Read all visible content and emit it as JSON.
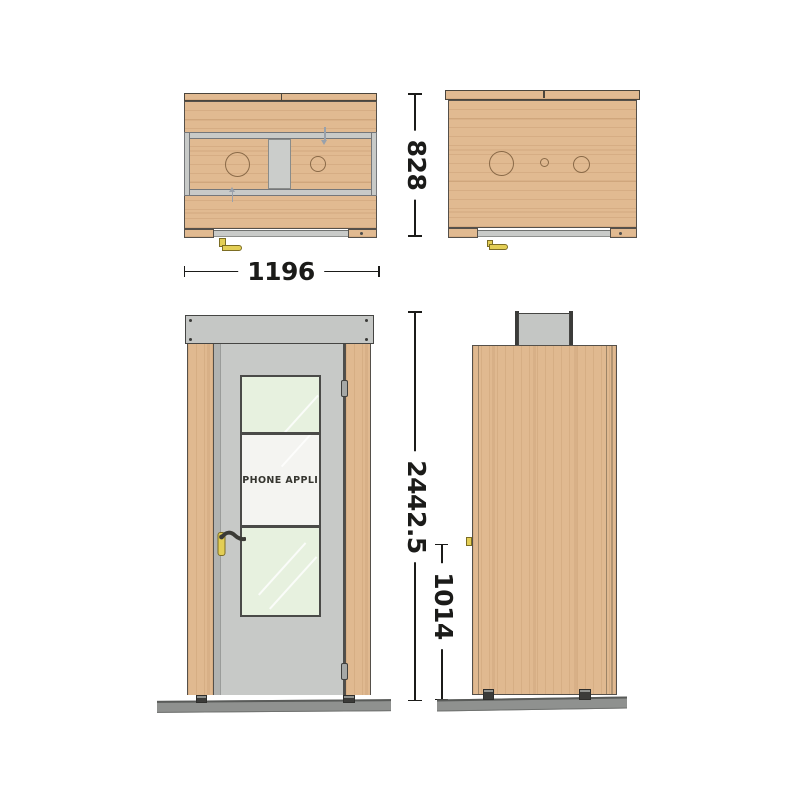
{
  "drawing": {
    "door_label": "PHONE APPLI",
    "dimensions": {
      "width": "1196",
      "depth": "828",
      "height": "2442.5",
      "handle_height": "1014"
    }
  },
  "colors": {
    "wood": "#e0b990",
    "metal_gray": "#c8cac8",
    "door_gray": "#c7c9c7",
    "glass_green": "#e7f1df",
    "glass_clear": "#f4f4f1",
    "brass_handle": "#e3ce55",
    "floor_gray": "#8f918f",
    "dimension_line": "#1b1b19"
  }
}
